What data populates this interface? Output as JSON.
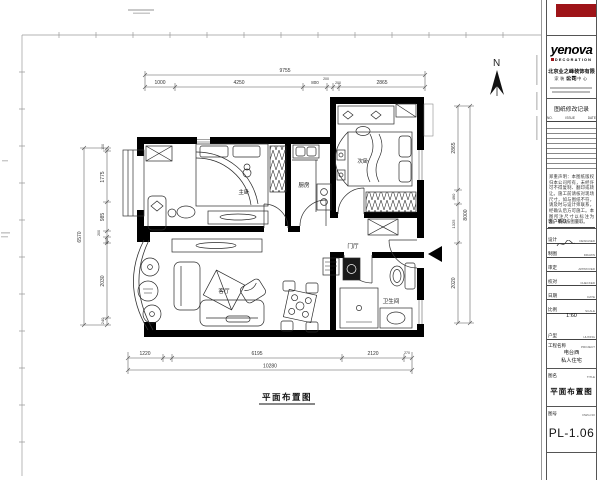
{
  "sheet": {
    "north": "N",
    "caption": "平面布置图"
  },
  "rooms": {
    "master_bedroom": "主卧",
    "kitchen": "厨房",
    "second_bedroom": "次卧",
    "foyer": "门厅",
    "living_room": "客厅",
    "bathroom": "卫生间"
  },
  "dims": {
    "top": {
      "total": "9755",
      "segments": [
        "1000",
        "4250",
        "800",
        "200",
        "200",
        "2865"
      ]
    },
    "left": {
      "total": "6570",
      "segments": [
        "100",
        "1775",
        "985",
        "200",
        "200",
        "2030",
        "240"
      ]
    },
    "bottom": {
      "total": "10280",
      "segments": [
        "1220",
        "6195",
        "2120",
        "270"
      ]
    },
    "right": {
      "total": "8000",
      "segments": [
        "2865",
        "490",
        "1325",
        "2020"
      ]
    }
  },
  "titleblock": {
    "logo": "yenova",
    "logo_sub": "DECORATION",
    "company_line1": "北京业之峰装饰有限公司",
    "company_line2": "家装设计中心",
    "revision_title": "图纸修改记录",
    "rev_cols": [
      "NO.",
      "ISSUE",
      "DATE"
    ],
    "notes": "郑重声明：本图纸版权归本公司所有，未经许可不得复制、翻印或转让。施工前请核对现场尺寸，如与图纸不符，请及时与设计师联系，经确认后方可施工。本图所注尺寸以标注为准，不得按图量取。",
    "confirm_label": "客户确认",
    "fields": [
      {
        "cn": "设计",
        "en": "DESIGNED"
      },
      {
        "cn": "制图",
        "en": "DRAWN"
      },
      {
        "cn": "审定",
        "en": "APPROVED"
      },
      {
        "cn": "校对",
        "en": "CHECKED"
      },
      {
        "cn": "日期",
        "en": "DATE"
      },
      {
        "cn": "比例",
        "en": "SCALE"
      },
      {
        "cn": "户型",
        "en": "HUXING"
      }
    ],
    "scale_value": "1:60",
    "project_cn": "工程名称",
    "project_en": "PROJECT",
    "project_value1": "电台西",
    "project_value2": "私人住宅",
    "title_cn": "图名",
    "title_en": "TITLE",
    "title_value": "平面布置图",
    "dwgno_cn": "图号",
    "dwgno_en": "DWG.NO",
    "dwgno_value": "PL-1.06"
  }
}
